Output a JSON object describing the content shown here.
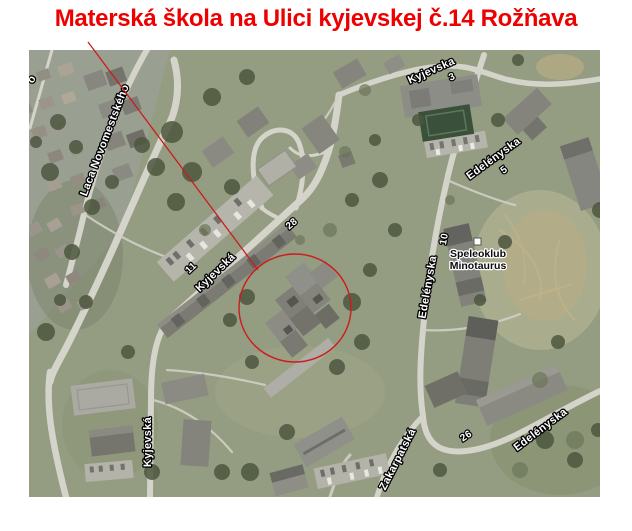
{
  "title": "Materská škola na Ulici kyjevskej č.14 Rožňava",
  "colors": {
    "title_red": "#ee0000",
    "annotation_red": "#cc1c1c",
    "road_label_fill": "#ffffff",
    "road_label_outline": "#000000",
    "poi_label_fill": "#0a0a0a",
    "poi_label_halo": "#ffffff"
  },
  "map": {
    "labels": {
      "laca": "Laca Novomestského",
      "kyjevska_central": "Kyjevská",
      "num_11": "11",
      "num_28": "28",
      "kyjevska_topright": "Kyjevska",
      "num_3": "3",
      "edelenyska_topright": "Edelényska",
      "num_5": "5",
      "edelenyska_middle": "Edelényska",
      "num_10": "10",
      "kyjevska_bottom": "Kyjevská",
      "zakarpatska": "Zakarpatská",
      "num_26": "26",
      "edelenyska_bottomright": "Edelényska",
      "edge_fragment": "o"
    },
    "poi": {
      "line1": "Speleoklub",
      "line2": "Minotaurus"
    }
  }
}
